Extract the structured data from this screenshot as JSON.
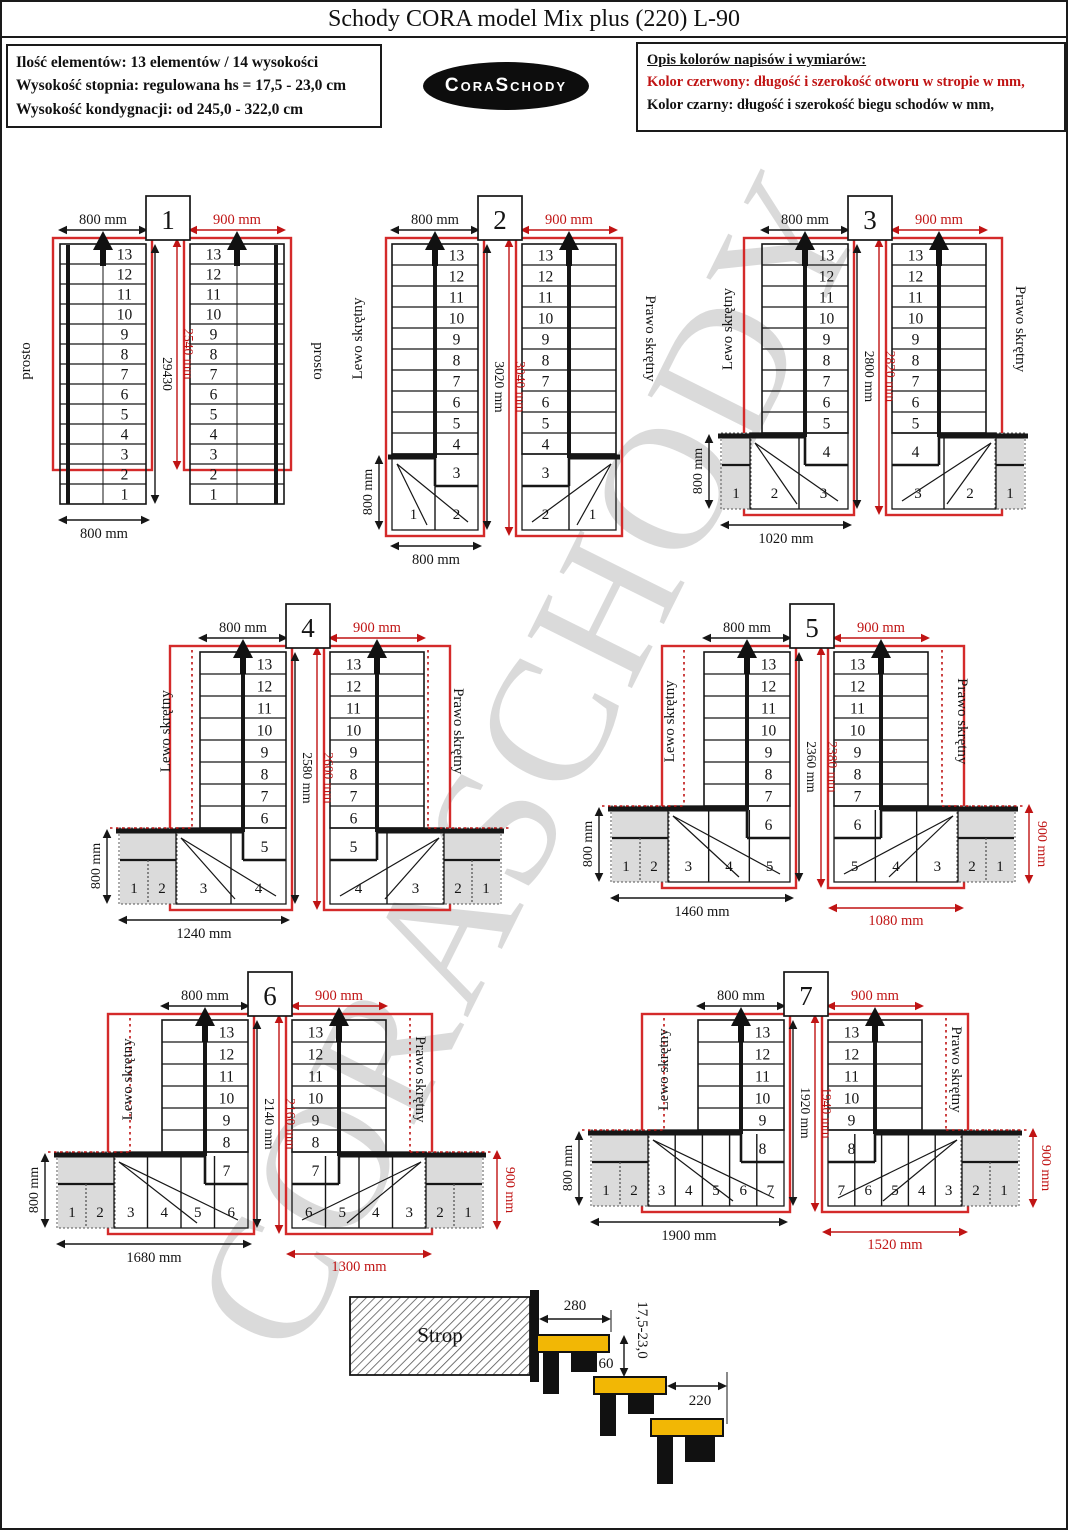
{
  "header": {
    "title": "Schody CORA model Mix plus (220) L-90"
  },
  "info_box": {
    "line1": "Ilość elementów: 13 elementów / 14 wysokości",
    "line2": "Wysokość stopnia: regulowana  hs = 17,5 - 23,0 cm",
    "line3": "Wysokość kondygnacji: od 245,0 - 322,0 cm"
  },
  "logo": {
    "text": "CoraSchody"
  },
  "legend": {
    "title": "Opis kolorów napisów i wymiarów:",
    "red_line": "Kolor czerwony: długość i szerokość otworu w stropie w mm,",
    "black_line": "Kolor czarny: długość i szerokość biegu schodów w mm,"
  },
  "watermark": "CORASCHODY",
  "colors": {
    "red": "#c01414",
    "redOutline": "#d42a2a",
    "gray": "#dbdbdb",
    "tread_yellow": "#f2b705",
    "black": "#161616"
  },
  "diagrams": [
    {
      "number": "1",
      "left": {
        "side_label": "prosto",
        "top_dim": "800 mm",
        "top_red": false,
        "steps": [
          "13",
          "12",
          "11",
          "10",
          "9",
          "8",
          "7",
          "6",
          "5",
          "4",
          "3",
          "2",
          "1"
        ],
        "turn_step": null,
        "cells": [],
        "bottom_dim": "800 mm",
        "left_dim": null,
        "bottom_dim_red": null,
        "right_dim_red": null
      },
      "center": {
        "black": "29430",
        "red": "2540 mm"
      },
      "right": {
        "side_label": "prosto",
        "top_dim": "900 mm",
        "top_red": true,
        "steps": [
          "13",
          "12",
          "11",
          "10",
          "9",
          "8",
          "7",
          "6",
          "5",
          "4",
          "3",
          "2",
          "1"
        ],
        "turn_step": null,
        "cells": [],
        "bottom_dim": null,
        "left_dim": null,
        "bottom_dim_red": null,
        "right_dim_red": null
      }
    },
    {
      "number": "2",
      "left": {
        "side_label": "Lewo skrętny",
        "top_dim": "800 mm",
        "top_red": false,
        "steps": [
          "13",
          "12",
          "11",
          "10",
          "9",
          "8",
          "7",
          "6",
          "5",
          "4"
        ],
        "turn_step": "3",
        "cells": [
          {
            "label": "1",
            "gray": false
          },
          {
            "label": "2",
            "gray": false
          }
        ],
        "bottom_dim": "800 mm",
        "left_dim": "800 mm",
        "bottom_dim_red": null,
        "right_dim_red": null
      },
      "center": {
        "black": "3020 mm",
        "red": "3040 mm"
      },
      "right": {
        "side_label": "Prawo skrętny",
        "top_dim": "900 mm",
        "top_red": true,
        "steps": [
          "13",
          "12",
          "11",
          "10",
          "9",
          "8",
          "7",
          "6",
          "5",
          "4"
        ],
        "turn_step": "3",
        "cells": [
          {
            "label": "2",
            "gray": false
          },
          {
            "label": "1",
            "gray": false
          }
        ],
        "bottom_dim": null,
        "left_dim": null,
        "bottom_dim_red": null,
        "right_dim_red": null
      }
    },
    {
      "number": "3",
      "left": {
        "side_label": "Lewo skrętny",
        "top_dim": "800 mm",
        "top_red": false,
        "steps": [
          "13",
          "12",
          "11",
          "10",
          "9",
          "8",
          "7",
          "6",
          "5"
        ],
        "turn_step": "4",
        "cells": [
          {
            "label": "1",
            "gray": true
          },
          {
            "label": "2",
            "gray": false
          },
          {
            "label": "3",
            "gray": false
          }
        ],
        "bottom_dim": "1020 mm",
        "left_dim": "800 mm",
        "bottom_dim_red": null,
        "right_dim_red": null
      },
      "center": {
        "black": "2800 mm",
        "red": "2820 mm"
      },
      "right": {
        "side_label": "Prawo skrętny",
        "top_dim": "900 mm",
        "top_red": true,
        "steps": [
          "13",
          "12",
          "11",
          "10",
          "9",
          "8",
          "7",
          "6",
          "5"
        ],
        "turn_step": "4",
        "cells": [
          {
            "label": "3",
            "gray": false
          },
          {
            "label": "2",
            "gray": false
          },
          {
            "label": "1",
            "gray": true
          }
        ],
        "bottom_dim": null,
        "left_dim": null,
        "bottom_dim_red": null,
        "right_dim_red": null
      }
    },
    {
      "number": "4",
      "left": {
        "side_label": "Lewo skrętny",
        "top_dim": "800 mm",
        "top_red": false,
        "steps": [
          "13",
          "12",
          "11",
          "10",
          "9",
          "8",
          "7",
          "6"
        ],
        "turn_step": "5",
        "cells": [
          {
            "label": "1",
            "gray": true
          },
          {
            "label": "2",
            "gray": true
          },
          {
            "label": "3",
            "gray": false
          },
          {
            "label": "4",
            "gray": false
          }
        ],
        "bottom_dim": "1240 mm",
        "left_dim": "800 mm",
        "bottom_dim_red": null,
        "right_dim_red": null
      },
      "center": {
        "black": "2580 mm",
        "red": "2600 mm"
      },
      "right": {
        "side_label": "Prawo skrętny",
        "top_dim": "900 mm",
        "top_red": true,
        "steps": [
          "13",
          "12",
          "11",
          "10",
          "9",
          "8",
          "7",
          "6"
        ],
        "turn_step": "5",
        "cells": [
          {
            "label": "4",
            "gray": false
          },
          {
            "label": "3",
            "gray": false
          },
          {
            "label": "2",
            "gray": true
          },
          {
            "label": "1",
            "gray": true
          }
        ],
        "bottom_dim": null,
        "left_dim": null,
        "bottom_dim_red": null,
        "right_dim_red": null
      }
    },
    {
      "number": "5",
      "left": {
        "side_label": "Lewo skrętny",
        "top_dim": "800 mm",
        "top_red": false,
        "steps": [
          "13",
          "12",
          "11",
          "10",
          "9",
          "8",
          "7"
        ],
        "turn_step": "6",
        "cells": [
          {
            "label": "1",
            "gray": true
          },
          {
            "label": "2",
            "gray": true
          },
          {
            "label": "3",
            "gray": false
          },
          {
            "label": "4",
            "gray": false
          },
          {
            "label": "5",
            "gray": false
          }
        ],
        "bottom_dim": "1460 mm",
        "left_dim": "800 mm",
        "bottom_dim_red": null,
        "right_dim_red": null
      },
      "center": {
        "black": "2360 mm",
        "red": "2380 mm"
      },
      "right": {
        "side_label": "Prawo skrętny",
        "top_dim": "900 mm",
        "top_red": true,
        "steps": [
          "13",
          "12",
          "11",
          "10",
          "9",
          "8",
          "7"
        ],
        "turn_step": "6",
        "cells": [
          {
            "label": "5",
            "gray": false
          },
          {
            "label": "4",
            "gray": false
          },
          {
            "label": "3",
            "gray": false
          },
          {
            "label": "2",
            "gray": true
          },
          {
            "label": "1",
            "gray": true
          }
        ],
        "bottom_dim": null,
        "left_dim": null,
        "bottom_dim_red": "1080 mm",
        "right_dim_red": "900 mm"
      }
    },
    {
      "number": "6",
      "left": {
        "side_label": "Lewo skrętny",
        "top_dim": "800 mm",
        "top_red": false,
        "steps": [
          "13",
          "12",
          "11",
          "10",
          "9",
          "8"
        ],
        "turn_step": "7",
        "cells": [
          {
            "label": "1",
            "gray": true
          },
          {
            "label": "2",
            "gray": true
          },
          {
            "label": "3",
            "gray": false
          },
          {
            "label": "4",
            "gray": false
          },
          {
            "label": "5",
            "gray": false
          },
          {
            "label": "6",
            "gray": false
          }
        ],
        "bottom_dim": "1680 mm",
        "left_dim": "800 mm",
        "bottom_dim_red": null,
        "right_dim_red": null
      },
      "center": {
        "black": "2140 mm",
        "red": "2160 mm"
      },
      "right": {
        "side_label": "Prawo skrętny",
        "top_dim": "900 mm",
        "top_red": true,
        "steps": [
          "13",
          "12",
          "11",
          "10",
          "9",
          "8"
        ],
        "turn_step": "7",
        "cells": [
          {
            "label": "6",
            "gray": false
          },
          {
            "label": "5",
            "gray": false
          },
          {
            "label": "4",
            "gray": false
          },
          {
            "label": "3",
            "gray": false
          },
          {
            "label": "2",
            "gray": true
          },
          {
            "label": "1",
            "gray": true
          }
        ],
        "bottom_dim": null,
        "left_dim": null,
        "bottom_dim_red": "1300 mm",
        "right_dim_red": "900 mm"
      }
    },
    {
      "number": "7",
      "left": {
        "side_label": "Lewo skrętny",
        "top_dim": "800 mm",
        "top_red": false,
        "steps": [
          "13",
          "12",
          "11",
          "10",
          "9"
        ],
        "turn_step": "8",
        "cells": [
          {
            "label": "1",
            "gray": true
          },
          {
            "label": "2",
            "gray": true
          },
          {
            "label": "3",
            "gray": false
          },
          {
            "label": "4",
            "gray": false
          },
          {
            "label": "5",
            "gray": false
          },
          {
            "label": "6",
            "gray": false
          },
          {
            "label": "7",
            "gray": false
          }
        ],
        "bottom_dim": "1900 mm",
        "left_dim": "800 mm",
        "bottom_dim_red": null,
        "right_dim_red": null
      },
      "center": {
        "black": "1920 mm",
        "red": "1940 mm"
      },
      "right": {
        "side_label": "Prawo skrętny",
        "top_dim": "900 mm",
        "top_red": true,
        "steps": [
          "13",
          "12",
          "11",
          "10",
          "9"
        ],
        "turn_step": "8",
        "cells": [
          {
            "label": "7",
            "gray": false
          },
          {
            "label": "6",
            "gray": false
          },
          {
            "label": "5",
            "gray": false
          },
          {
            "label": "4",
            "gray": false
          },
          {
            "label": "3",
            "gray": false
          },
          {
            "label": "2",
            "gray": true
          },
          {
            "label": "1",
            "gray": true
          }
        ],
        "bottom_dim": null,
        "left_dim": null,
        "bottom_dim_red": "1520 mm",
        "right_dim_red": "900 mm"
      }
    }
  ],
  "profile": {
    "label": "Strop",
    "dim_depth": "280",
    "dim_overlap": "60",
    "dim_rise": "17,5-23,0",
    "dim_tread": "220"
  }
}
